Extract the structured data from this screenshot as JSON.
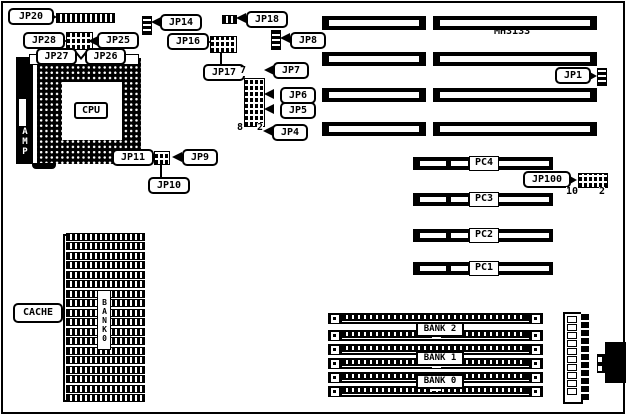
{
  "colors": {
    "ink": "#000000",
    "paper": "#ffffff"
  },
  "board": {
    "model": "MH3133",
    "cpu": "CPU",
    "amp": "AMP",
    "cache": "CACHE",
    "cache_bank_vertical": "BANK0"
  },
  "jumpers": {
    "jp1": "JP1",
    "jp4": "JP4",
    "jp5": "JP5",
    "jp6": "JP6",
    "jp7": "JP7",
    "jp8": "JP8",
    "jp9": "JP9",
    "jp10": "JP10",
    "jp11": "JP11",
    "jp14": "JP14",
    "jp16": "JP16",
    "jp17": "JP17",
    "jp18": "JP18",
    "jp20": "JP20",
    "jp25": "JP25",
    "jp26": "JP26",
    "jp27": "JP27",
    "jp28": "JP28",
    "jp100": "JP100"
  },
  "pin_numbers": {
    "jp_block_top": "7",
    "jp_block_bottom_left": "8",
    "jp_block_bottom_right": "2",
    "jp100_left": "10",
    "jp100_right": "2"
  },
  "pc_slots": [
    {
      "label": "PC4"
    },
    {
      "label": "PC3"
    },
    {
      "label": "PC2"
    },
    {
      "label": "PC1"
    }
  ],
  "memory_banks": [
    {
      "label": "BANK 2"
    },
    {
      "label": "BANK 1"
    },
    {
      "label": "BANK 0"
    }
  ]
}
